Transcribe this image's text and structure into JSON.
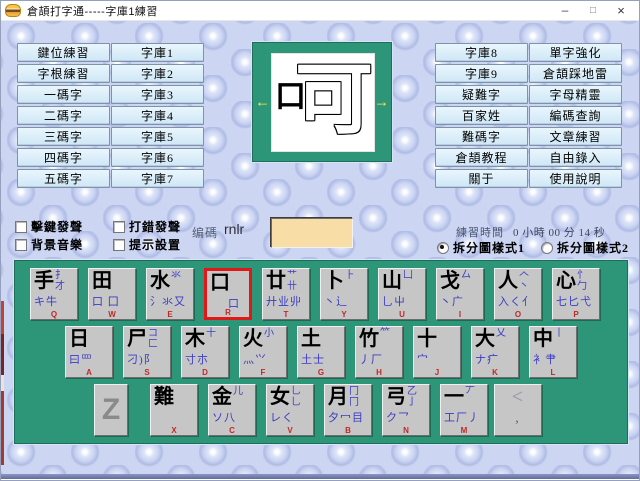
{
  "window": {
    "title": "倉頡打字通-----字庫1練習",
    "minimize": "–",
    "maximize": "□",
    "close": "×"
  },
  "left_buttons": {
    "col1": [
      "鍵位練習",
      "字根練習",
      "一碼字",
      "二碼字",
      "三碼字",
      "四碼字",
      "五碼字"
    ],
    "col2": [
      "字庫1",
      "字庫2",
      "字庫3",
      "字庫4",
      "字庫5",
      "字庫6",
      "字庫7"
    ]
  },
  "right_buttons": {
    "col1": [
      "字庫8",
      "字庫9",
      "疑難字",
      "百家姓",
      "難碼字",
      "倉頡教程",
      "關于"
    ],
    "col2": [
      "單字強化",
      "倉頡踩地雷",
      "字母精靈",
      "編碼查詢",
      "文章練習",
      "自由錄入",
      "使用說明"
    ]
  },
  "char_display": {
    "prev_arrow": "←",
    "next_arrow": "→",
    "filled_component": "口",
    "outline_component": "可"
  },
  "options": {
    "checkboxes": [
      {
        "label": "擊鍵發聲",
        "checked": false
      },
      {
        "label": "打錯發聲",
        "checked": false
      },
      {
        "label": "背景音樂",
        "checked": false
      },
      {
        "label": "提示設置",
        "checked": false
      }
    ],
    "code_label": "编碼",
    "code_value": "rnlr",
    "input_value": ""
  },
  "practice": {
    "time_label": "練習時間",
    "time_value": "0 小時 00 分 14 秒",
    "radios": [
      {
        "label": "拆分圖樣式1",
        "selected": true
      },
      {
        "label": "拆分圖樣式2",
        "selected": false
      }
    ]
  },
  "keyboard": {
    "highlight_key": "R",
    "rows": [
      [
        {
          "main": "手",
          "top": "扌才",
          "bottom": "キ牛",
          "letter": "Q"
        },
        {
          "main": "田",
          "top": "",
          "bottom": "口 囗",
          "letter": "W"
        },
        {
          "main": "水",
          "top": "氺",
          "bottom": "氵氺又",
          "letter": "E"
        },
        {
          "main": "口",
          "top": "",
          "bottom": "口",
          "letter": "R",
          "selected": true
        },
        {
          "main": "廿",
          "top": "艹卄",
          "bottom": "廾业丱",
          "letter": "T"
        },
        {
          "main": "卜",
          "top": "⺊",
          "bottom": "丶辶",
          "letter": "Y"
        },
        {
          "main": "山",
          "top": "凵",
          "bottom": "乚屮",
          "letter": "U"
        },
        {
          "main": "戈",
          "top": "厶",
          "bottom": "丶广",
          "letter": "I"
        },
        {
          "main": "人",
          "top": "𠆢丶",
          "bottom": "入く亻",
          "letter": "O"
        },
        {
          "main": "心",
          "top": "忄勹",
          "bottom": "七匕弋",
          "letter": "P"
        }
      ],
      [
        {
          "main": "日",
          "top": "",
          "bottom": "曰罒",
          "letter": "A"
        },
        {
          "main": "尸",
          "top": "コ匚",
          "bottom": "刁)阝",
          "letter": "S"
        },
        {
          "main": "木",
          "top": "十",
          "bottom": "寸朩",
          "letter": "D"
        },
        {
          "main": "火",
          "top": "小",
          "bottom": "灬⺍",
          "letter": "F"
        },
        {
          "main": "土",
          "top": "",
          "bottom": "土士",
          "letter": "G"
        },
        {
          "main": "竹",
          "top": "⺮",
          "bottom": "丿厂",
          "letter": "H"
        },
        {
          "main": "十",
          "top": "",
          "bottom": "宀",
          "letter": "J"
        },
        {
          "main": "大",
          "top": "乂",
          "bottom": "ナ疒",
          "letter": "K"
        },
        {
          "main": "中",
          "top": "丨",
          "bottom": "衤肀",
          "letter": "L"
        }
      ],
      [
        {
          "main": "Z",
          "top": "",
          "bottom": "",
          "letter": "",
          "z_key": true
        },
        {
          "main": "難",
          "top": "",
          "bottom": "",
          "letter": "X"
        },
        {
          "main": "金",
          "top": "儿",
          "bottom": "ソ八",
          "letter": "C"
        },
        {
          "main": "女",
          "top": "乚乚",
          "bottom": "レく",
          "letter": "V"
        },
        {
          "main": "月",
          "top": "冂冂",
          "bottom": "夕冖目",
          "letter": "B"
        },
        {
          "main": "弓",
          "top": "乙亅",
          "bottom": "ク乛",
          "letter": "N"
        },
        {
          "main": "一",
          "top": "丆",
          "bottom": "工厂丿",
          "letter": "M"
        },
        {
          "main": "<",
          "top": "",
          "bottom": ",",
          "letter": "",
          "comma_key": true
        }
      ]
    ]
  },
  "colors": {
    "keyboard_bg": "#2e9678",
    "key_bg": "#c6c6c6",
    "key_highlight_border": "#e01818",
    "aux_blue": "#3b3bc4",
    "letter_red": "#c02828",
    "input_bg": "#f9dda6",
    "arrow_yellow": "#f2ea4a",
    "wallpaper": "#ccd6f3"
  }
}
